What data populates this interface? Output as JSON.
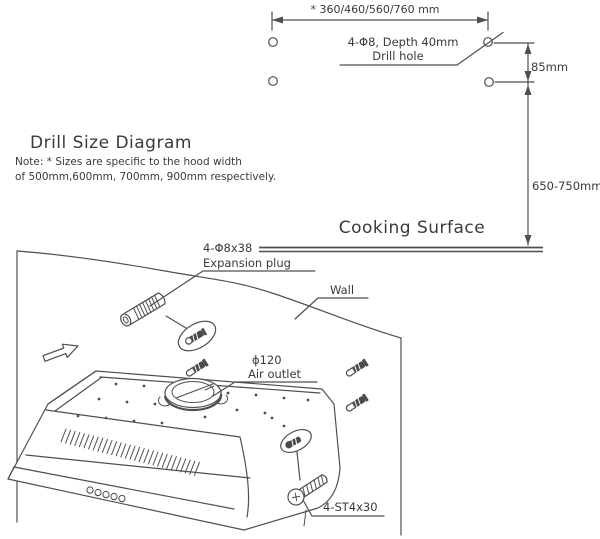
{
  "title": "Drill Size Diagram",
  "note": {
    "line1": "Note: * Sizes are specific to the hood width",
    "line2": "of 500mm,600mm, 700mm, 900mm respectively."
  },
  "drill": {
    "width_dim": "* 360/460/560/760 mm",
    "hole_spec1": "4-Φ8, Depth 40mm",
    "hole_spec2": "Drill hole",
    "dim_85": "85mm",
    "dim_650": "650-750mm",
    "cooking_surface": "Cooking Surface"
  },
  "install": {
    "plug1": "4-Φ8x38",
    "plug2": "Expansion plug",
    "wall": "Wall",
    "outlet1": "ϕ120",
    "outlet2": "Air outlet",
    "screw": "4-ST4x30"
  },
  "colors": {
    "line": "#4f4f4f",
    "text": "#3a3a3a",
    "dark_fill": "#4a4a4a",
    "background": "#ffffff"
  }
}
